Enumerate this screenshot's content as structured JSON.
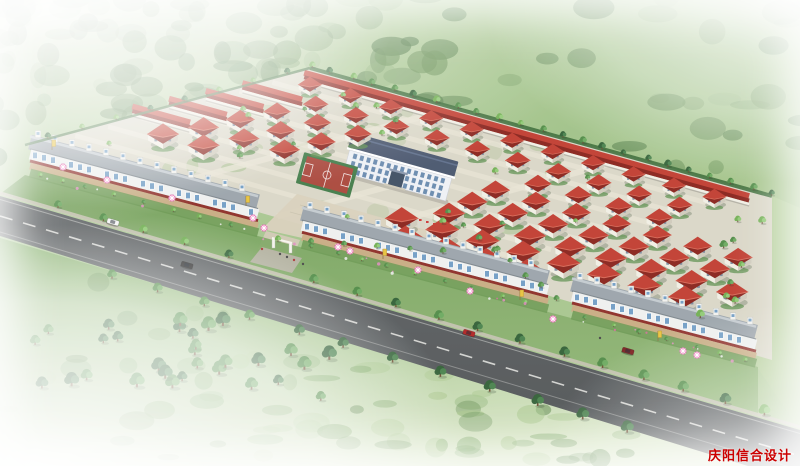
{
  "watermark": {
    "text": "庆阳信合设计",
    "color": "#cc0000"
  },
  "palette": {
    "field_light": "#c6d9b2",
    "field_mid": "#9fc186",
    "field_deep": "#86b06d",
    "forest_dark": "#4f7a44",
    "forest_mid": "#6d955b",
    "forest_light": "#8fb27a",
    "site_ground": "#d9d6c6",
    "street": "#e8e4d4",
    "roof_red_light": "#c03a2d",
    "roof_red_dark": "#871f18",
    "roof_ridge": "#da6a58",
    "wall_white": "#f1eee4",
    "wall_shade": "#cfc9ba",
    "shop_roof": "#99a2a9",
    "shop_roof_light": "#c3cacf",
    "shop_wall": "#eef0ef",
    "shop_window": "#6f9cc4",
    "awning_red": "#8c2a24",
    "sidewalk": "#c9aa80",
    "plaza": "#d8d0ba",
    "civic_roof": "#46536b",
    "civic_wall": "#eef1f5",
    "court_red": "#a84438",
    "court_green": "#3f7a46",
    "road_asphalt": "#5d6163",
    "road_dark": "#4b4f51",
    "road_line": "#e8e8e4",
    "curb": "#c6c2b2",
    "tree_dark": "#2f5e33",
    "tree_mid": "#4e8a44",
    "tree_light": "#6fae50",
    "hedge": "#3a6b36",
    "verge_green": "#69974f",
    "umbrella_pink": "#ee66b0",
    "flag_yellow": "#e8c23a",
    "car_white": "#f4f4f4",
    "car_black": "#2a2a2a",
    "car_red": "#b02020",
    "car_maroon": "#7c1d1d",
    "gate_white": "#f6f4ec"
  }
}
